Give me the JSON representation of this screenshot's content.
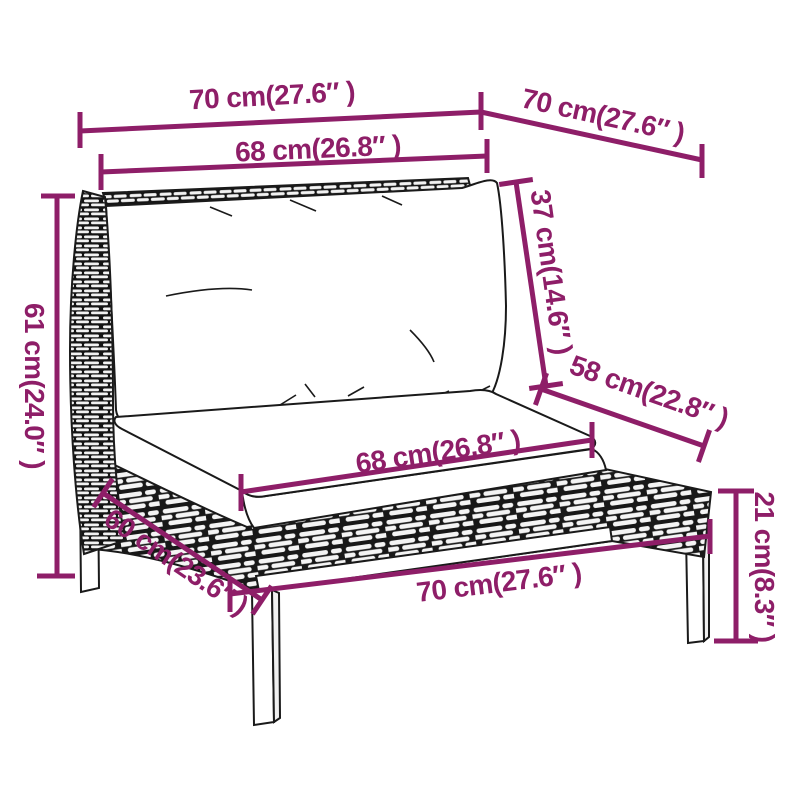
{
  "diagram": {
    "type": "product-dimension-diagram",
    "subject": "poly-rattan middle sofa section with cushions",
    "accent_color": "#8e1e68",
    "line_color": "#1a1a1a",
    "background_color": "#ffffff",
    "dimensions": [
      {
        "id": "top-width",
        "label": "70 cm(27.6″ )"
      },
      {
        "id": "top-depth",
        "label": "70 cm(27.6″ )"
      },
      {
        "id": "back-cushion-width",
        "label": "68 cm(26.8″ )"
      },
      {
        "id": "overall-height",
        "label": "61 cm(24.0″ )"
      },
      {
        "id": "back-cushion-height",
        "label": "37 cm(14.6″ )"
      },
      {
        "id": "seat-depth",
        "label": "58 cm(22.8″ )"
      },
      {
        "id": "seat-cushion-width",
        "label": "68 cm(26.8″ )"
      },
      {
        "id": "seat-height",
        "label": "21 cm(8.3″ )"
      },
      {
        "id": "base-depth",
        "label": "60 cm(23.6″ )"
      },
      {
        "id": "base-width",
        "label": "70 cm(27.6″ )"
      }
    ]
  }
}
